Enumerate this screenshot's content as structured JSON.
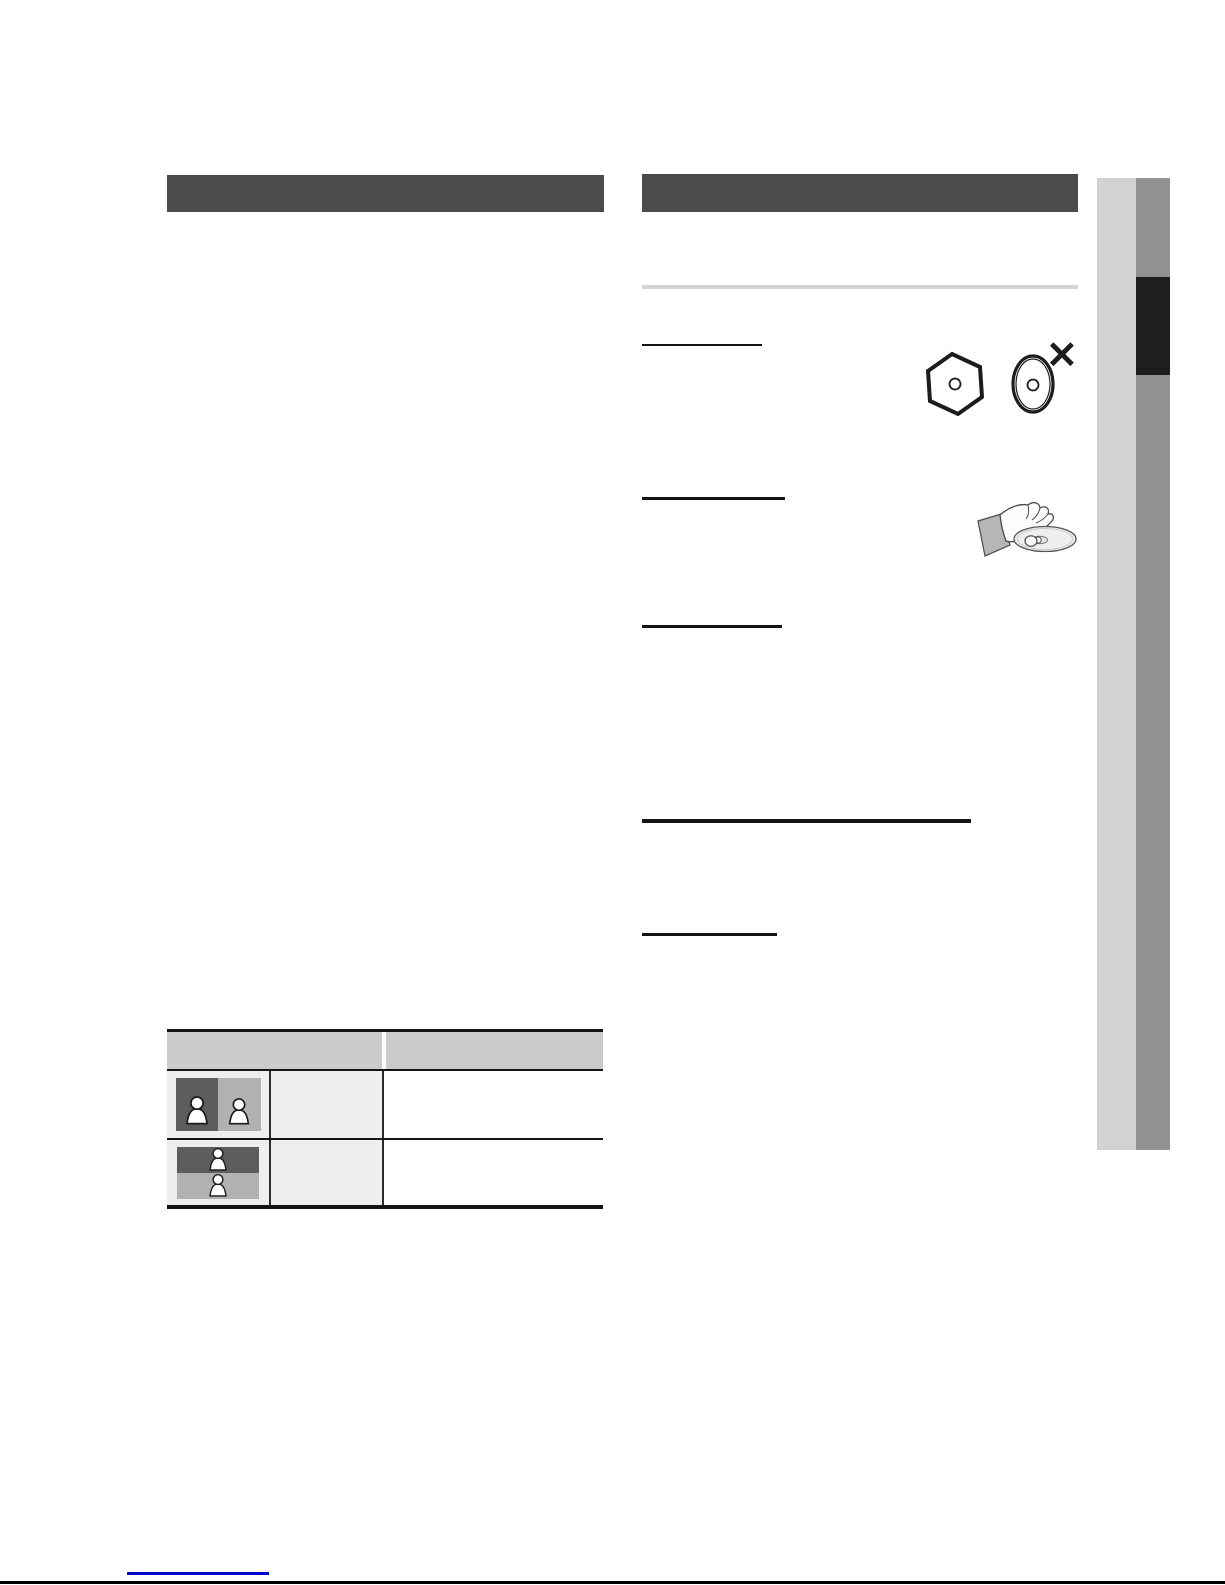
{
  "page": {
    "kind": "scanned-manual-page",
    "columns": 2
  },
  "colors": {
    "page": "#ffffff",
    "bar": "#4c4a4b",
    "divider": "#d4d4d4",
    "rule": "#141414",
    "side-light": "#d2d2d2",
    "side-dark": "#929092",
    "side-black": "#201d1e",
    "th-bg": "#cbcbcb",
    "td-bg": "#efeeee",
    "fig-dark": "#5d5d5f",
    "fig-light": "#b1b1b3",
    "link": "#0000cc",
    "edge": "#000000",
    "stroke": "#1c1c1c",
    "sleeve": "#b6b6b6"
  },
  "figures": {
    "disc_shapes": {
      "cross_glyph": "✕",
      "items": [
        "hexagon-shaped-disc",
        "oval-shaped-disc"
      ]
    },
    "hand_disc": "hand-holding-disc-by-edges",
    "table_figures": [
      "side-by-side-format",
      "top-and-bottom-format"
    ]
  }
}
